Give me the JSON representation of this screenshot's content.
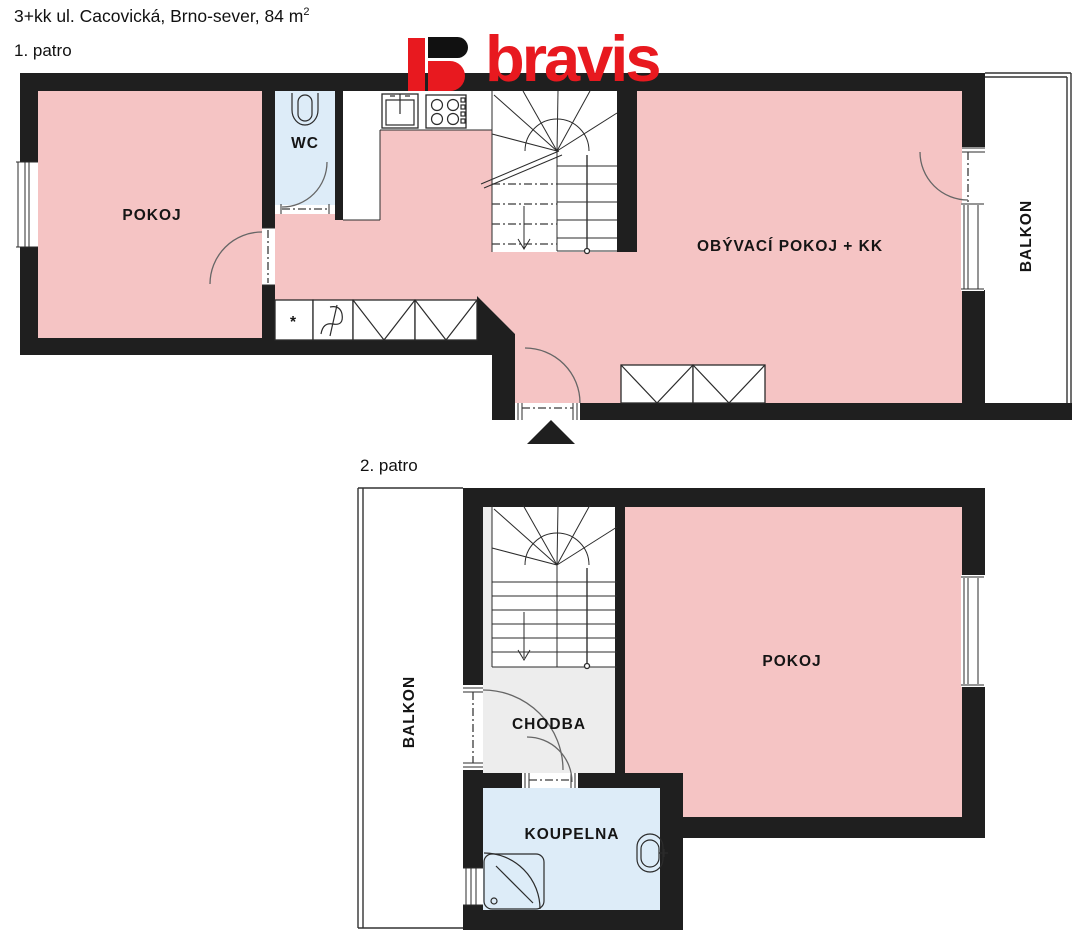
{
  "header": {
    "title": "3+kk ul. Cacovická, Brno-sever, 84 m",
    "area_superscript": "2",
    "floor1_label": "1. patro",
    "floor2_label": "2. patro"
  },
  "logo": {
    "wordmark": "bravis",
    "red": "#e8191f",
    "black": "#111111"
  },
  "floor1": {
    "pokoj": "POKOJ",
    "wc": "WC",
    "living": "OBÝVACÍ POKOJ + KK",
    "balkon": "BALKON",
    "washer_mark": "*"
  },
  "floor2": {
    "pokoj": "POKOJ",
    "chodba": "CHODBA",
    "koupelna": "KOUPELNA",
    "balkon": "BALKON"
  },
  "colors": {
    "room_pink": "#f5c4c4",
    "bath_blue": "#ddecf8",
    "hall_gray": "#ededed",
    "wall": "#1f1f1f",
    "brand_red": "#e8191f"
  }
}
